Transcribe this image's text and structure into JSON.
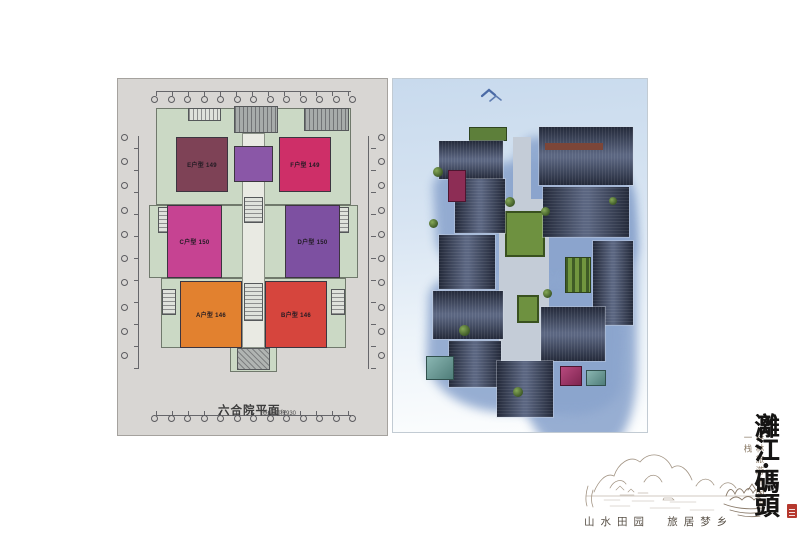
{
  "floor_plan": {
    "title": "六合院平面",
    "subtitle": "基底面积930",
    "plate_color": "#d8d6d3",
    "footprint_color": "#cbd9c5",
    "hall_color": "#8a57a7",
    "rooms": [
      {
        "label": "E户型 149",
        "color": "#7e4256"
      },
      {
        "label": "F户型 149",
        "color": "#ce2f68"
      },
      {
        "label": "C户型 150",
        "color": "#c64392"
      },
      {
        "label": "D户型 150",
        "color": "#7d50a1"
      },
      {
        "label": "A户型 146",
        "color": "#e2812f"
      },
      {
        "label": "B户型 146",
        "color": "#d6453d"
      }
    ]
  },
  "render": {
    "sky_color": "#c8daed",
    "shadow_color": "#8aa4cd",
    "roof_color": "#2c3445",
    "lawn_color": "#6e9140"
  },
  "branding": {
    "logo_vertical": "灕江·碼頭",
    "slogan_vertical": "桂林旅游休闲第一栈",
    "tagline": "山水田园  旅居梦乡",
    "seal_color": "#b5382e"
  }
}
